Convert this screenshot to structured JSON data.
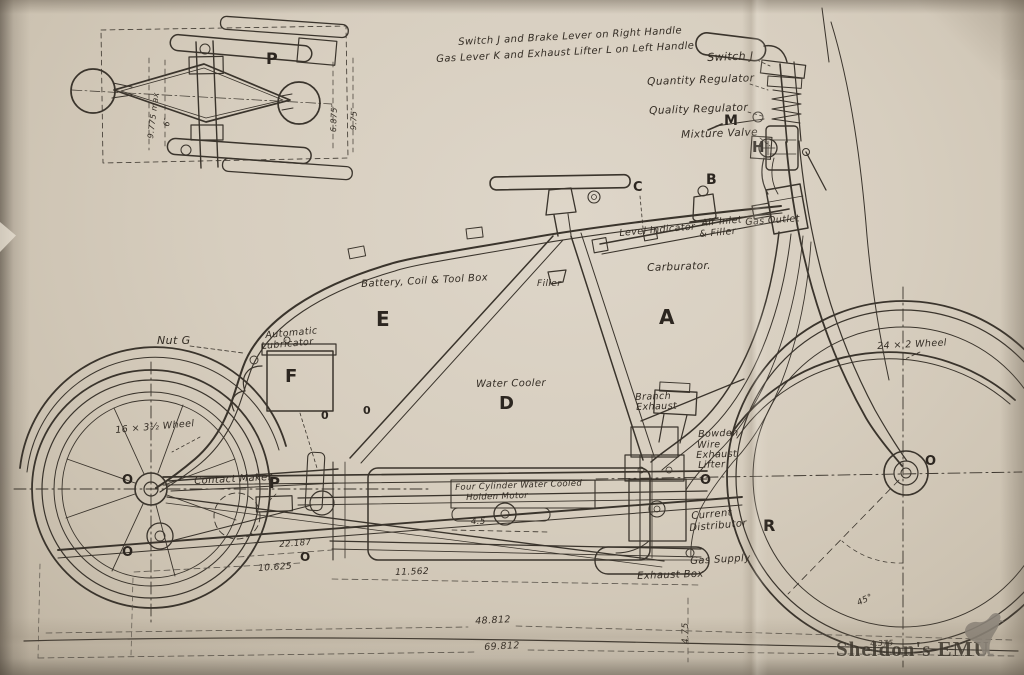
{
  "document": {
    "type": "technical drawing",
    "subject": "Holden four-cylinder motorcycle — side elevation with handlebar plan inset"
  },
  "colors": {
    "paper": "#d7cebf",
    "paper_edge": "#bdb2a0",
    "ink": "#3a342c",
    "dimension_ink": "#5a544b",
    "watermark": "#8b847a"
  },
  "watermark": {
    "text": "Sheldon's EMU",
    "icon": "emu-bird"
  },
  "labels": [
    {
      "name": "label-switch-brake-handle",
      "text": "Switch J and Brake Lever on Right Handle",
      "x": 458,
      "y": 38,
      "fs": 10,
      "rot": -3
    },
    {
      "name": "label-gas-lever-handle",
      "text": "Gas Lever K and Exhaust Lifter L on Left Handle",
      "x": 436,
      "y": 55,
      "fs": 10,
      "rot": -3
    },
    {
      "name": "label-switch-j",
      "text": "Switch J",
      "x": 707,
      "y": 52,
      "fs": 11,
      "rot": -2
    },
    {
      "name": "label-quantity-regulator",
      "text": "Quantity Regulator",
      "x": 647,
      "y": 77,
      "fs": 10.5,
      "rot": -2
    },
    {
      "name": "label-quality-regulator",
      "text": "Quality Regulator",
      "x": 649,
      "y": 106,
      "fs": 10.5,
      "rot": -2
    },
    {
      "name": "part-letter-m",
      "text": "M",
      "x": 724,
      "y": 114,
      "fs": 14,
      "b": true
    },
    {
      "name": "label-mixture-valve",
      "text": "Mixture Valve",
      "x": 681,
      "y": 130,
      "fs": 10.5,
      "rot": -2
    },
    {
      "name": "part-letter-h",
      "text": "H",
      "x": 752,
      "y": 140,
      "fs": 15,
      "b": true
    },
    {
      "name": "part-letter-c",
      "text": "C",
      "x": 633,
      "y": 181,
      "fs": 13,
      "b": true
    },
    {
      "name": "part-letter-b",
      "text": "B",
      "x": 706,
      "y": 173,
      "fs": 14,
      "b": true
    },
    {
      "name": "label-level-indicator",
      "text": "Level Indicator",
      "x": 619,
      "y": 229,
      "fs": 9.5,
      "rot": -5
    },
    {
      "name": "label-air-inlet",
      "text": "Air Inlet",
      "x": 701,
      "y": 219,
      "fs": 9.5,
      "rot": -5
    },
    {
      "name": "label-air-inlet-filler",
      "text": "& Filler",
      "x": 699,
      "y": 230,
      "fs": 9.5,
      "rot": -5
    },
    {
      "name": "label-gas-outlet",
      "text": "Gas Outlet",
      "x": 745,
      "y": 218,
      "fs": 9.5,
      "rot": -4
    },
    {
      "name": "label-carburator",
      "text": "Carburator.",
      "x": 647,
      "y": 263,
      "fs": 10.5,
      "rot": -2
    },
    {
      "name": "part-letter-a",
      "text": "A",
      "x": 659,
      "y": 307,
      "fs": 20,
      "b": true
    },
    {
      "name": "label-battery-coil-toolbox",
      "text": "Battery, Coil & Tool Box",
      "x": 361,
      "y": 280,
      "fs": 10,
      "rot": -3
    },
    {
      "name": "part-letter-e",
      "text": "E",
      "x": 376,
      "y": 309,
      "fs": 20,
      "b": true
    },
    {
      "name": "label-filler",
      "text": "Filler",
      "x": 537,
      "y": 280,
      "fs": 9
    },
    {
      "name": "label-nut-g",
      "text": "Nut G",
      "x": 157,
      "y": 335,
      "fs": 11
    },
    {
      "name": "label-automatic",
      "text": "Automatic",
      "x": 265,
      "y": 331,
      "fs": 9.5,
      "rot": -5
    },
    {
      "name": "label-lubricator",
      "text": "Lubricator",
      "x": 261,
      "y": 342,
      "fs": 9.5,
      "rot": -5
    },
    {
      "name": "part-letter-f",
      "text": "F",
      "x": 285,
      "y": 368,
      "fs": 18,
      "b": true
    },
    {
      "name": "label-water-cooler",
      "text": "Water Cooler",
      "x": 476,
      "y": 380,
      "fs": 10,
      "rot": -1
    },
    {
      "name": "part-letter-d",
      "text": "D",
      "x": 499,
      "y": 395,
      "fs": 18,
      "b": true
    },
    {
      "name": "label-branch-exhaust-1",
      "text": "Branch",
      "x": 635,
      "y": 393,
      "fs": 9.5,
      "rot": -2
    },
    {
      "name": "label-branch-exhaust-2",
      "text": "Exhaust",
      "x": 636,
      "y": 403,
      "fs": 9.5,
      "rot": -2
    },
    {
      "name": "label-bowden-1",
      "text": "Bowden",
      "x": 698,
      "y": 430,
      "fs": 9.5,
      "rot": -2
    },
    {
      "name": "label-bowden-2",
      "text": "Wire",
      "x": 697,
      "y": 441,
      "fs": 9.5,
      "rot": -2
    },
    {
      "name": "label-bowden-3",
      "text": "Exhaust",
      "x": 696,
      "y": 451,
      "fs": 9.5,
      "rot": -2
    },
    {
      "name": "label-bowden-4",
      "text": "Lifter",
      "x": 698,
      "y": 461,
      "fs": 9.5,
      "rot": -2
    },
    {
      "name": "mark-o-bowden",
      "text": "O",
      "x": 700,
      "y": 474,
      "fs": 13,
      "b": true
    },
    {
      "name": "label-current-distributor-1",
      "text": "Current",
      "x": 691,
      "y": 512,
      "fs": 10,
      "rot": -5
    },
    {
      "name": "label-current-distributor-2",
      "text": "Distributor",
      "x": 689,
      "y": 524,
      "fs": 10,
      "rot": -5
    },
    {
      "name": "part-letter-r",
      "text": "R",
      "x": 763,
      "y": 518,
      "fs": 16,
      "b": true
    },
    {
      "name": "label-gas-supply",
      "text": "Gas Supply",
      "x": 690,
      "y": 557,
      "fs": 10,
      "rot": -3
    },
    {
      "name": "label-exhaust-box",
      "text": "Exhaust Box",
      "x": 637,
      "y": 572,
      "fs": 10,
      "rot": -2
    },
    {
      "name": "label-front-wheel",
      "text": "24 × 2 Wheel",
      "x": 877,
      "y": 342,
      "fs": 9.5,
      "rot": -3
    },
    {
      "name": "label-rear-wheel",
      "text": "16 × 3½ Wheel",
      "x": 115,
      "y": 426,
      "fs": 9.5,
      "rot": -5
    },
    {
      "name": "label-contact-maker",
      "text": "Contact Maker",
      "x": 194,
      "y": 477,
      "fs": 10,
      "rot": -3
    },
    {
      "name": "part-letter-p",
      "text": "P",
      "x": 269,
      "y": 476,
      "fs": 15,
      "b": true
    },
    {
      "name": "label-motor-1",
      "text": "Four Cylinder Water Cooled",
      "x": 455,
      "y": 484,
      "fs": 8.5,
      "rot": -2
    },
    {
      "name": "label-motor-2",
      "text": "Holden Motor",
      "x": 466,
      "y": 494,
      "fs": 8.5,
      "rot": -2
    },
    {
      "name": "dim-motor",
      "text": "4.5",
      "x": 471,
      "y": 518,
      "fs": 8.5
    },
    {
      "name": "dim-22-187",
      "text": "22.187",
      "x": 279,
      "y": 541,
      "fs": 8.5,
      "rot": -4
    },
    {
      "name": "mark-o-center",
      "text": "O",
      "x": 300,
      "y": 551,
      "fs": 12,
      "b": true
    },
    {
      "name": "dim-10-625",
      "text": "10.625",
      "x": 258,
      "y": 565,
      "fs": 9,
      "rot": -4
    },
    {
      "name": "dim-11-562",
      "text": "11.562",
      "x": 395,
      "y": 569,
      "fs": 9,
      "rot": -2
    },
    {
      "name": "dim-48-812",
      "text": "48.812",
      "x": 475,
      "y": 617,
      "fs": 9.5,
      "rot": -3
    },
    {
      "name": "dim-69-812",
      "text": "69.812",
      "x": 484,
      "y": 643,
      "fs": 9.5,
      "rot": -3
    },
    {
      "name": "dim-4-75",
      "text": "4.75",
      "x": 682,
      "y": 644,
      "fs": 9,
      "rot": -90
    },
    {
      "name": "dim-45-deg",
      "text": "45°",
      "x": 856,
      "y": 600,
      "fs": 8.5,
      "rot": -25
    },
    {
      "name": "dim-4-375",
      "text": "4.375",
      "x": 870,
      "y": 640,
      "fs": 7.5,
      "rot": -2
    },
    {
      "name": "mark-o-front-hub",
      "text": "O",
      "x": 925,
      "y": 455,
      "fs": 13,
      "b": true
    },
    {
      "name": "mark-o-rear-hub",
      "text": "O",
      "x": 122,
      "y": 474,
      "fs": 13,
      "b": true
    },
    {
      "name": "mark-o-rear-low",
      "text": "O",
      "x": 122,
      "y": 546,
      "fs": 13,
      "b": true
    },
    {
      "name": "mark-o-frame-1",
      "text": "0",
      "x": 321,
      "y": 410,
      "fs": 11,
      "b": true
    },
    {
      "name": "mark-o-frame-2",
      "text": "0",
      "x": 363,
      "y": 405,
      "fs": 11,
      "b": true
    },
    {
      "name": "part-letter-p-inset",
      "text": "P",
      "x": 266,
      "y": 51,
      "fs": 16,
      "b": true
    },
    {
      "name": "dim-inset-9-775",
      "text": "9.775 max",
      "x": 147,
      "y": 138,
      "fs": 8,
      "rot": -83
    },
    {
      "name": "dim-inset-6",
      "text": "6″",
      "x": 163,
      "y": 126,
      "fs": 8,
      "rot": -83
    },
    {
      "name": "dim-inset-6-875",
      "text": "6.875″",
      "x": 330,
      "y": 132,
      "fs": 8,
      "rot": -88
    },
    {
      "name": "dim-inset-9-75",
      "text": "9.75″",
      "x": 350,
      "y": 130,
      "fs": 8,
      "rot": -88
    }
  ]
}
